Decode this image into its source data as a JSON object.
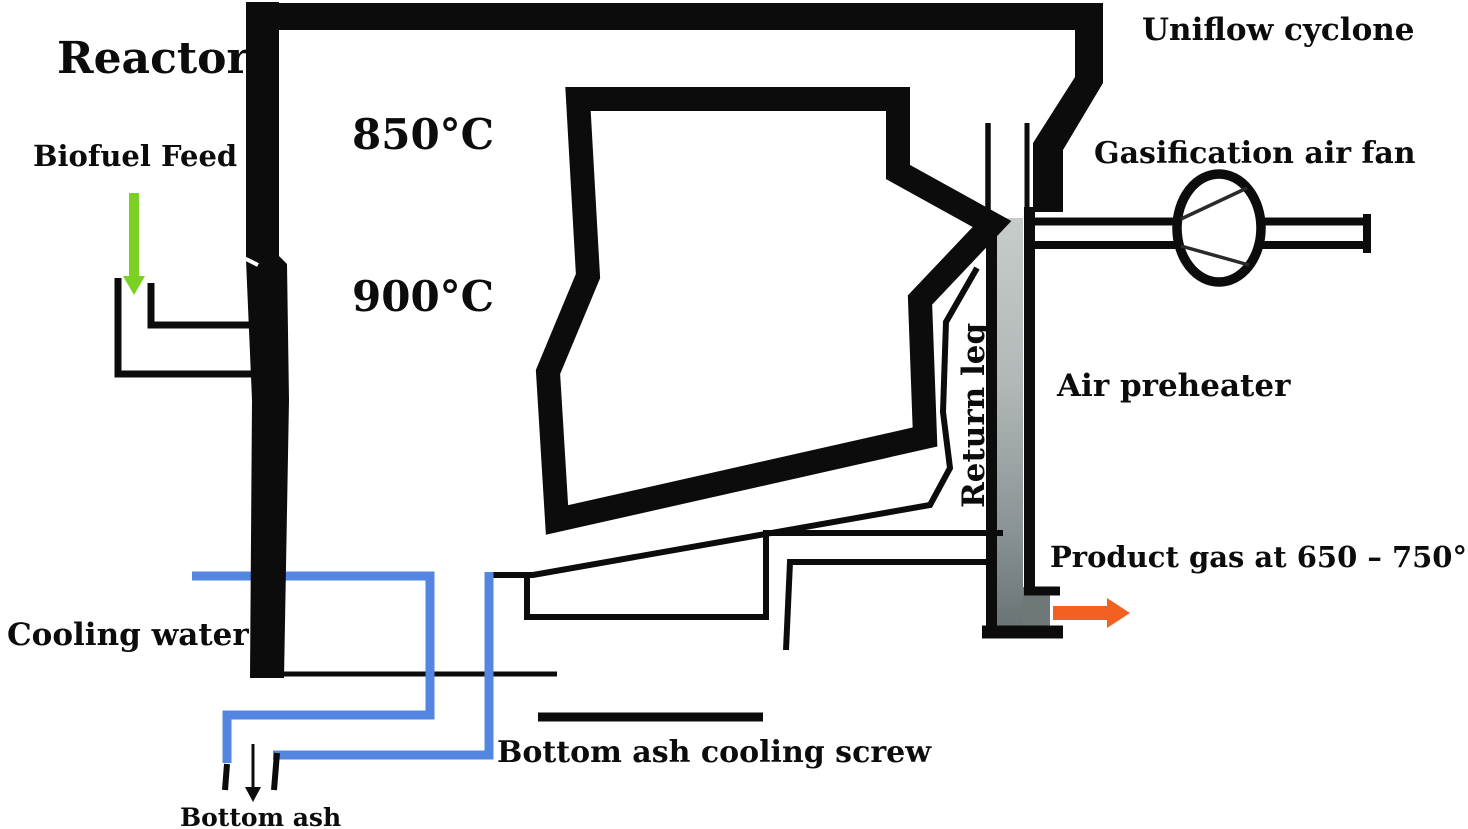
{
  "diagram": {
    "type": "gasifier-process-flow",
    "labels": {
      "reactor": "Reactor",
      "biofuel_feed": "Biofuel Feed",
      "temp_upper": "850°C",
      "temp_lower": "900°C",
      "uniflow_cyclone": "Uniflow cyclone",
      "gasification_air_fan": "Gasification air fan",
      "air_preheater": "Air preheater",
      "return_leg": "Return leg",
      "product_gas": "Product gas at 650 – 750°C",
      "cooling_water": "Cooling water",
      "bottom_ash_cooling_screw": "Bottom ash cooling screw",
      "bottom_ash": "Bottom ash"
    },
    "colors": {
      "line_black": "#0c0c0c",
      "biofuel_arrow_green": "#7bd121",
      "cooling_water_blue": "#5386e0",
      "product_gas_orange": "#f26122",
      "preheater_gray_top": "#c7cccb",
      "preheater_gray_bottom": "#6a7374"
    }
  }
}
